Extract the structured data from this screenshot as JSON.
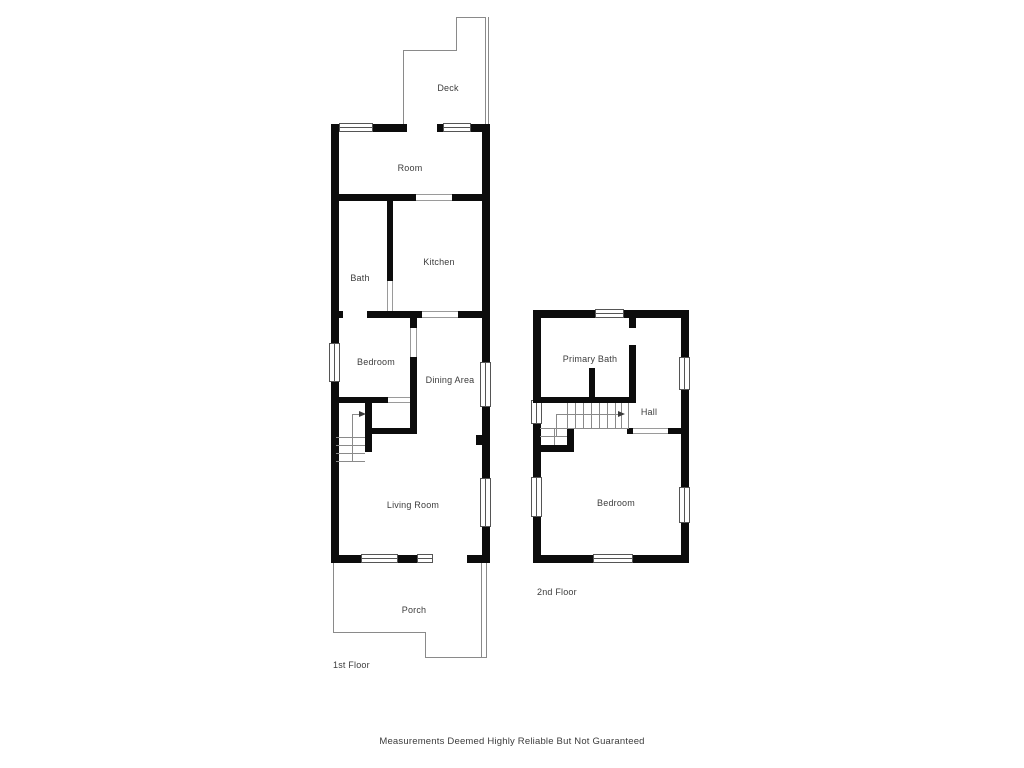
{
  "first_floor": {
    "floor_label": "1st Floor",
    "rooms": {
      "deck": "Deck",
      "room": "Room",
      "kitchen": "Kitchen",
      "bath": "Bath",
      "bedroom": "Bedroom",
      "dining_area": "Dining Area",
      "living_room": "Living Room",
      "porch": "Porch"
    }
  },
  "second_floor": {
    "floor_label": "2nd Floor",
    "rooms": {
      "primary_bath": "Primary Bath",
      "hall": "Hall",
      "bedroom": "Bedroom"
    }
  },
  "footer": {
    "disclaimer": "Measurements Deemed Highly Reliable But Not Guaranteed"
  },
  "colors": {
    "wall": "#0c0c0c",
    "thin_line": "#8a8a8a",
    "window_border": "#555555",
    "text": "#3c3c3c",
    "background": "#ffffff"
  }
}
